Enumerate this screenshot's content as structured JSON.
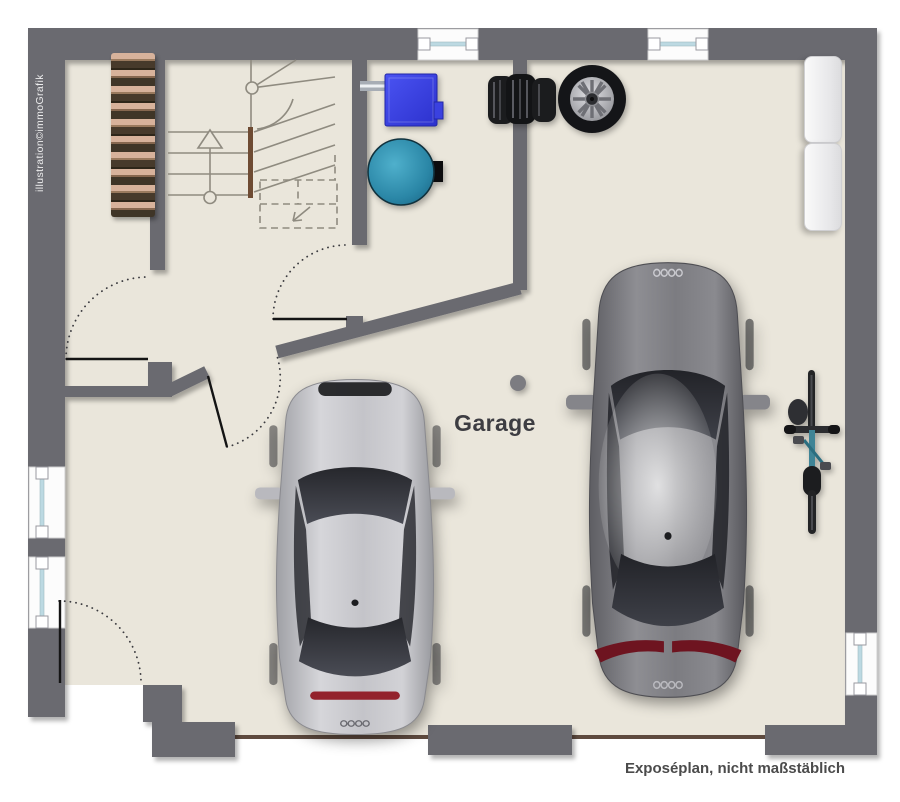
{
  "page": {
    "type": "garage-floor-plan",
    "room_label": "Garage",
    "watermark": "illustration©immoGrafik",
    "disclaimer": "Exposéplan, nicht maßstäblich"
  },
  "colors": {
    "wall_gray": "#6a6a6f",
    "floor_beige": "#eae6db",
    "outside_white": "#ffffff",
    "boiler_blue": "#3a41e0",
    "tank_teal": "#2e8fae",
    "firewood_tan": "#d7b29b",
    "threshold_brown": "#5e4a3e",
    "window_glass_blue": "#bcd9e2",
    "stair_line_gray": "#8f8b80",
    "stringer_brown": "#6e4b33",
    "label_text": "#3d3d42"
  },
  "objects": [
    "staircase",
    "firewood-rack",
    "heating-boiler",
    "water-tank",
    "tire-stack",
    "spare-wheel",
    "wall-shelf-upper",
    "wall-shelf-lower",
    "support-column",
    "silver-car",
    "gray-car",
    "bicycle",
    "window-top-left",
    "window-top-right",
    "window-left-upper",
    "window-left-lower",
    "window-right",
    "garage-door-left",
    "garage-door-right"
  ]
}
